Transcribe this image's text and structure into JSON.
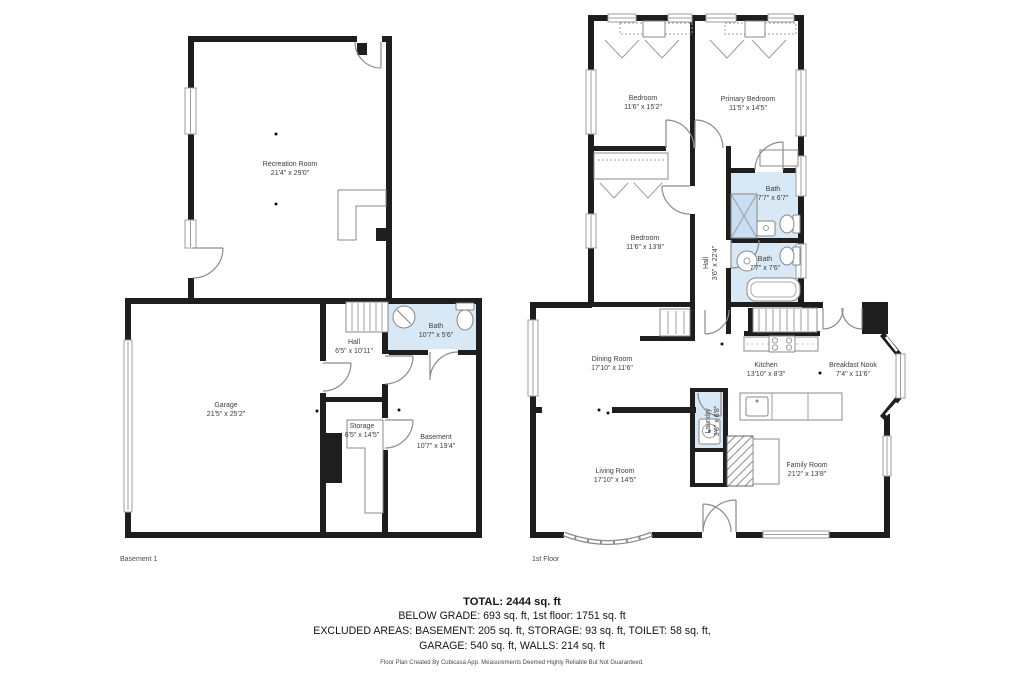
{
  "page": {
    "background": "#ffffff"
  },
  "colors": {
    "wall": "#1e1e1e",
    "bath_fill": "#d8e8f5",
    "thin_line": "#8c8c8c"
  },
  "floors": [
    {
      "label": "Basement 1",
      "rooms": [
        {
          "name": "Recreation Room",
          "dims": "21'4\" x 29'0\""
        },
        {
          "name": "Garage",
          "dims": "21'5\" x 25'2\""
        },
        {
          "name": "Hall",
          "dims": "6'5\" x 10'11\""
        },
        {
          "name": "Bath",
          "dims": "10'7\" x 5'6\""
        },
        {
          "name": "Storage",
          "dims": "6'5\" x 14'5\""
        },
        {
          "name": "Basement",
          "dims": "10'7\" x 19'4\""
        }
      ]
    },
    {
      "label": "1st Floor",
      "rooms": [
        {
          "name": "Bedroom",
          "dims": "11'6\" x 15'2\""
        },
        {
          "name": "Primary Bedroom",
          "dims": "11'5\" x 14'5\""
        },
        {
          "name": "Bedroom",
          "dims": "11'6\" x 13'8\""
        },
        {
          "name": "Hall",
          "dims": "3'6\" x 22'4\""
        },
        {
          "name": "Bath",
          "dims": "7'7\" x 6'7\""
        },
        {
          "name": "Bath",
          "dims": "7'7\" x 7'6\""
        },
        {
          "name": "Dining Room",
          "dims": "17'10\" x 11'6\""
        },
        {
          "name": "Kitchen",
          "dims": "13'10\" x 8'3\""
        },
        {
          "name": "Breakfast Nook",
          "dims": "7'4\" x 11'6\""
        },
        {
          "name": "Laundry",
          "dims": "3'6\" x 6'8\""
        },
        {
          "name": "Living Room",
          "dims": "17'10\" x 14'5\""
        },
        {
          "name": "Family Room",
          "dims": "21'2\" x 13'8\""
        }
      ]
    }
  ],
  "summary": {
    "total": "TOTAL: 2444 sq. ft",
    "grade_line": "BELOW GRADE: 693 sq. ft, 1st floor: 1751 sq. ft",
    "excluded_line1": "EXCLUDED AREAS: BASEMENT: 205 sq. ft, STORAGE: 93 sq. ft, TOILET: 58 sq. ft,",
    "excluded_line2": "GARAGE: 540 sq. ft, WALLS: 214 sq. ft"
  },
  "footer": "Floor Plan Created By Cubicasa App. Measurements Deemed Highly Reliable But Not Guaranteed."
}
